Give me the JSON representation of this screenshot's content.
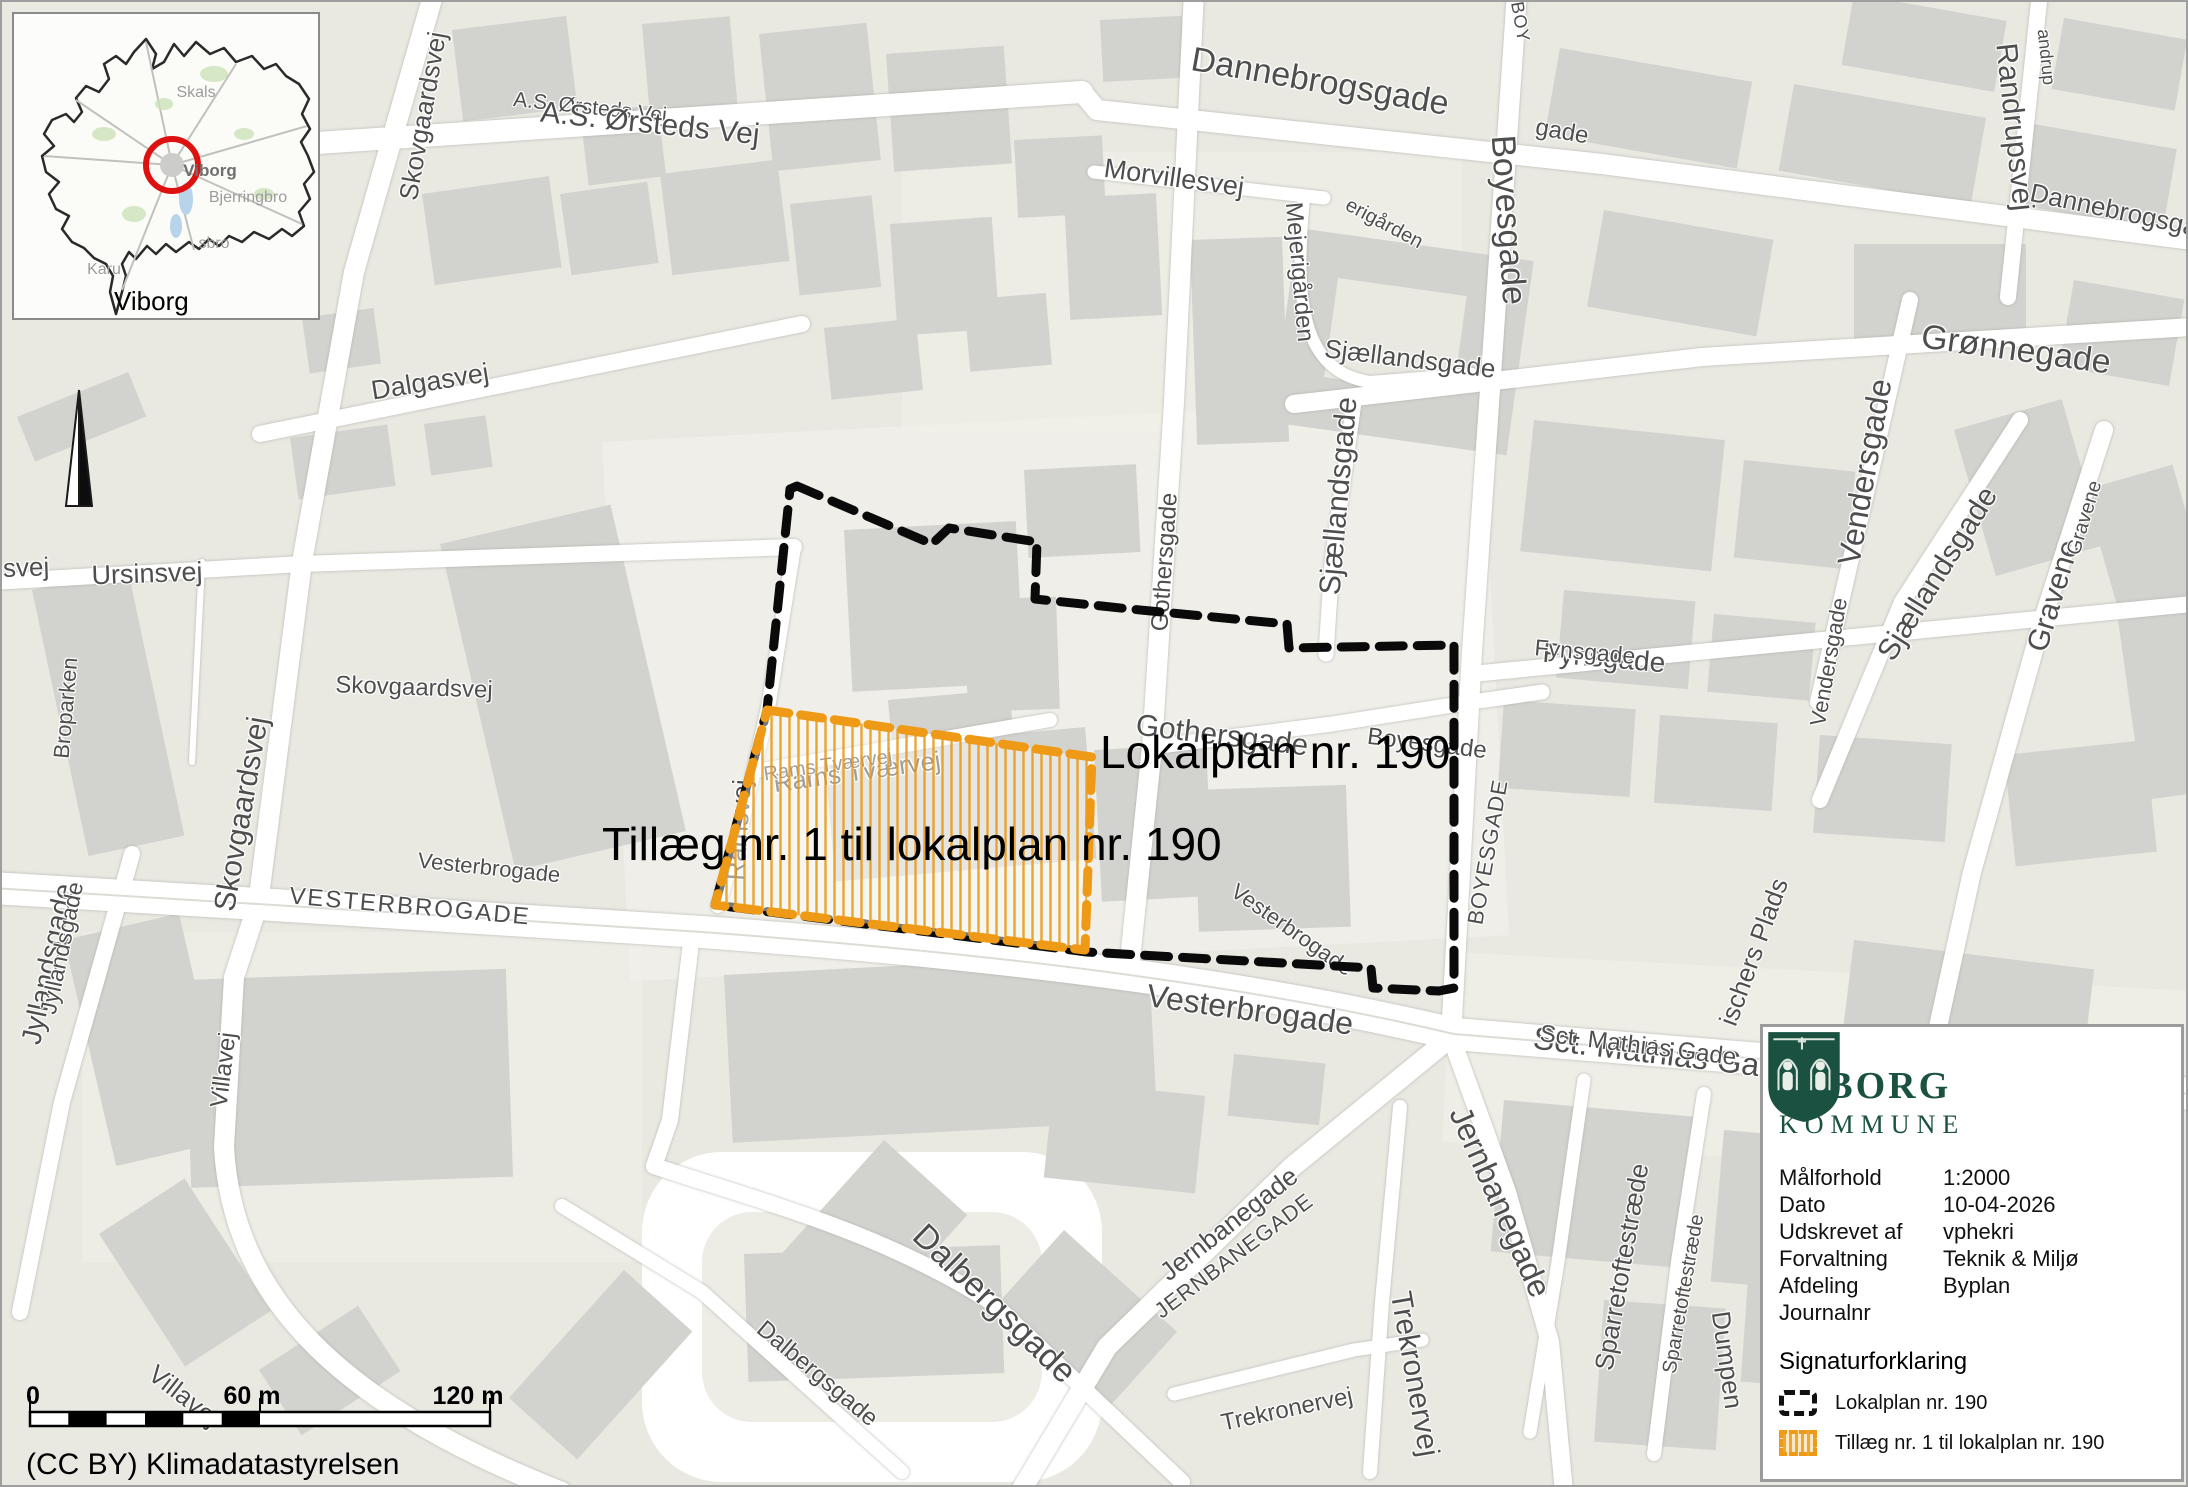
{
  "map": {
    "plan_labels": {
      "lokalplan": "Lokalplan nr. 190",
      "tillaeg": "Tillæg nr. 1 til lokalplan nr. 190"
    },
    "colors": {
      "lokalplan_outline": "#0a0a0a",
      "tillaeg_outline": "#ef9a16",
      "tillaeg_hatch": "#e8960f",
      "building": "#d2d2cf",
      "background": "#e9e8e1",
      "road": "#ffffff"
    },
    "streets": [
      {
        "t": "Skovgaardsvej",
        "x": 421,
        "y": 114,
        "r": -80,
        "s": 26
      },
      {
        "t": "A.S. Ørsteds Vej",
        "x": 588,
        "y": 106,
        "r": 6,
        "s": 21
      },
      {
        "t": "A.S. Ørsteds Vej",
        "x": 648,
        "y": 122,
        "r": 6,
        "s": 30
      },
      {
        "t": "Dalgasvej",
        "x": 428,
        "y": 380,
        "r": -9,
        "s": 27
      },
      {
        "t": "Ursinsvej",
        "x": 145,
        "y": 572,
        "r": -2,
        "s": 27
      },
      {
        "t": "insvej",
        "x": 14,
        "y": 566,
        "r": -2,
        "s": 26
      },
      {
        "t": "Broparken",
        "x": 64,
        "y": 706,
        "r": -85,
        "s": 22
      },
      {
        "t": "Skovgaardsvej",
        "x": 240,
        "y": 812,
        "r": -80,
        "s": 30
      },
      {
        "t": "Skovgaardsvej",
        "x": 412,
        "y": 686,
        "r": 2,
        "s": 24
      },
      {
        "t": "Vesterbrogade",
        "x": 487,
        "y": 866,
        "r": 6,
        "s": 22
      },
      {
        "t": "VESTERBROGADE",
        "x": 408,
        "y": 905,
        "r": 5,
        "s": 24,
        "sp": 2
      },
      {
        "t": "Jyllandsgade",
        "x": 46,
        "y": 962,
        "r": -78,
        "s": 28
      },
      {
        "t": "Jyllandsgade",
        "x": 60,
        "y": 946,
        "r": -78,
        "s": 23
      },
      {
        "t": "Villavej",
        "x": 222,
        "y": 1068,
        "r": -83,
        "s": 24
      },
      {
        "t": "Villavej",
        "x": 182,
        "y": 1394,
        "r": 38,
        "s": 26
      },
      {
        "t": "Ramsvej",
        "x": 737,
        "y": 828,
        "r": -86,
        "s": 26
      },
      {
        "t": "Rams Tværvej",
        "x": 855,
        "y": 770,
        "r": -8,
        "s": 26
      },
      {
        "t": "Rams Tværvej",
        "x": 826,
        "y": 764,
        "r": -8,
        "s": 20
      },
      {
        "t": "Dannebrogsgade",
        "x": 1318,
        "y": 80,
        "r": 10,
        "s": 34
      },
      {
        "t": "gade",
        "x": 1560,
        "y": 130,
        "r": 10,
        "s": 24
      },
      {
        "t": "Morvillesvej",
        "x": 1172,
        "y": 176,
        "r": 8,
        "s": 27
      },
      {
        "t": "Mejerigården",
        "x": 1297,
        "y": 270,
        "r": 85,
        "s": 24
      },
      {
        "t": "erigården",
        "x": 1382,
        "y": 222,
        "r": 28,
        "s": 20
      },
      {
        "t": "Boyesgade",
        "x": 1506,
        "y": 218,
        "r": 86,
        "s": 34
      },
      {
        "t": "BOY",
        "x": 1518,
        "y": 20,
        "r": 80,
        "s": 18,
        "sp": 1
      },
      {
        "t": "Randrupsvej",
        "x": 2012,
        "y": 125,
        "r": 84,
        "s": 30
      },
      {
        "t": "andrup",
        "x": 2044,
        "y": 55,
        "r": 84,
        "s": 18
      },
      {
        "t": "Dannebrogsga",
        "x": 2112,
        "y": 208,
        "r": 12,
        "s": 26
      },
      {
        "t": "Grønnegade",
        "x": 2014,
        "y": 348,
        "r": 8,
        "s": 34
      },
      {
        "t": "Sjællandsgade",
        "x": 1408,
        "y": 357,
        "r": 7,
        "s": 26
      },
      {
        "t": "Sjællandsgade",
        "x": 1337,
        "y": 494,
        "r": -85,
        "s": 30
      },
      {
        "t": "Gothersgade",
        "x": 1163,
        "y": 560,
        "r": -86,
        "s": 24
      },
      {
        "t": "Gothersgade",
        "x": 1220,
        "y": 734,
        "r": 7,
        "s": 30
      },
      {
        "t": "Boyesgade",
        "x": 1425,
        "y": 742,
        "r": 7,
        "s": 24
      },
      {
        "t": "Fynsgade",
        "x": 1602,
        "y": 656,
        "r": 5,
        "s": 28
      },
      {
        "t": "Fynsgade",
        "x": 1583,
        "y": 650,
        "r": 5,
        "s": 23
      },
      {
        "t": "Vendersgade",
        "x": 1863,
        "y": 470,
        "r": -80,
        "s": 32
      },
      {
        "t": "Vendersgade",
        "x": 1827,
        "y": 660,
        "r": -80,
        "s": 22
      },
      {
        "t": "Sjællandsgade",
        "x": 1936,
        "y": 572,
        "r": -58,
        "s": 30
      },
      {
        "t": "Gravene",
        "x": 2052,
        "y": 594,
        "r": -73,
        "s": 30
      },
      {
        "t": "Gravene",
        "x": 2083,
        "y": 516,
        "r": -73,
        "s": 20
      },
      {
        "t": "BOYESGADE",
        "x": 1486,
        "y": 850,
        "r": -80,
        "s": 22,
        "sp": 1
      },
      {
        "t": "Vesterbrogade",
        "x": 1290,
        "y": 928,
        "r": 35,
        "s": 22
      },
      {
        "t": "Vesterbrogade",
        "x": 1248,
        "y": 1008,
        "r": 8,
        "s": 32
      },
      {
        "t": "Sct. Mathias Gade",
        "x": 1662,
        "y": 1052,
        "r": 7,
        "s": 32
      },
      {
        "t": "Sct. Mathias Gade",
        "x": 1636,
        "y": 1044,
        "r": 7,
        "s": 24
      },
      {
        "t": "Jernbanegade",
        "x": 1227,
        "y": 1222,
        "r": -38,
        "s": 26
      },
      {
        "t": "JERNBANEGADE",
        "x": 1232,
        "y": 1254,
        "r": -37,
        "s": 22,
        "sp": 1
      },
      {
        "t": "Jernbanegade",
        "x": 1498,
        "y": 1200,
        "r": 66,
        "s": 32
      },
      {
        "t": "Dalbergsgade",
        "x": 992,
        "y": 1302,
        "r": 44,
        "s": 34
      },
      {
        "t": "Dalbergsgade",
        "x": 815,
        "y": 1372,
        "r": 40,
        "s": 24
      },
      {
        "t": "Trekronervej",
        "x": 1285,
        "y": 1408,
        "r": -12,
        "s": 24
      },
      {
        "t": "Trekronervej",
        "x": 1412,
        "y": 1372,
        "r": 80,
        "s": 30
      },
      {
        "t": "Sparretoftestræde",
        "x": 1620,
        "y": 1265,
        "r": -80,
        "s": 26
      },
      {
        "t": "Sparretoftestræde",
        "x": 1682,
        "y": 1292,
        "r": -80,
        "s": 20
      },
      {
        "t": "Dumpen",
        "x": 1725,
        "y": 1358,
        "r": 82,
        "s": 26
      },
      {
        "t": "ischers Plads",
        "x": 1752,
        "y": 950,
        "r": -70,
        "s": 26
      }
    ]
  },
  "inset": {
    "towns": [
      {
        "t": "Skals",
        "x": 182,
        "y": 79,
        "b": 0
      },
      {
        "t": "Viborg",
        "x": 196,
        "y": 157,
        "b": 1
      },
      {
        "t": "Bjerringbro",
        "x": 234,
        "y": 184,
        "b": 0
      },
      {
        "t": "sbro",
        "x": 200,
        "y": 230,
        "b": 0
      },
      {
        "t": "Karu",
        "x": 90,
        "y": 256,
        "b": 0
      }
    ],
    "caption": "Viborg"
  },
  "scalebar": {
    "labels": [
      "0",
      "60 m",
      "120 m"
    ]
  },
  "attribution": "(CC BY) Klimadatastyrelsen",
  "infobox": {
    "logo": {
      "title": "VİBORG",
      "subtitle": "KOMMUNE"
    },
    "rows": [
      {
        "label": "Målforhold",
        "value": "1:2000"
      },
      {
        "label": "Dato",
        "value": "10-04-2026"
      },
      {
        "label": "Udskrevet af",
        "value": "vphekri"
      },
      {
        "label": "Forvaltning",
        "value": "Teknik & Miljø"
      },
      {
        "label": "Afdeling",
        "value": "Byplan"
      },
      {
        "label": "Journalnr",
        "value": ""
      }
    ],
    "legend": {
      "title": "Signaturforklaring",
      "items": [
        {
          "label": "Lokalplan nr. 190"
        },
        {
          "label": "Tillæg nr. 1 til lokalplan nr. 190"
        }
      ]
    }
  }
}
